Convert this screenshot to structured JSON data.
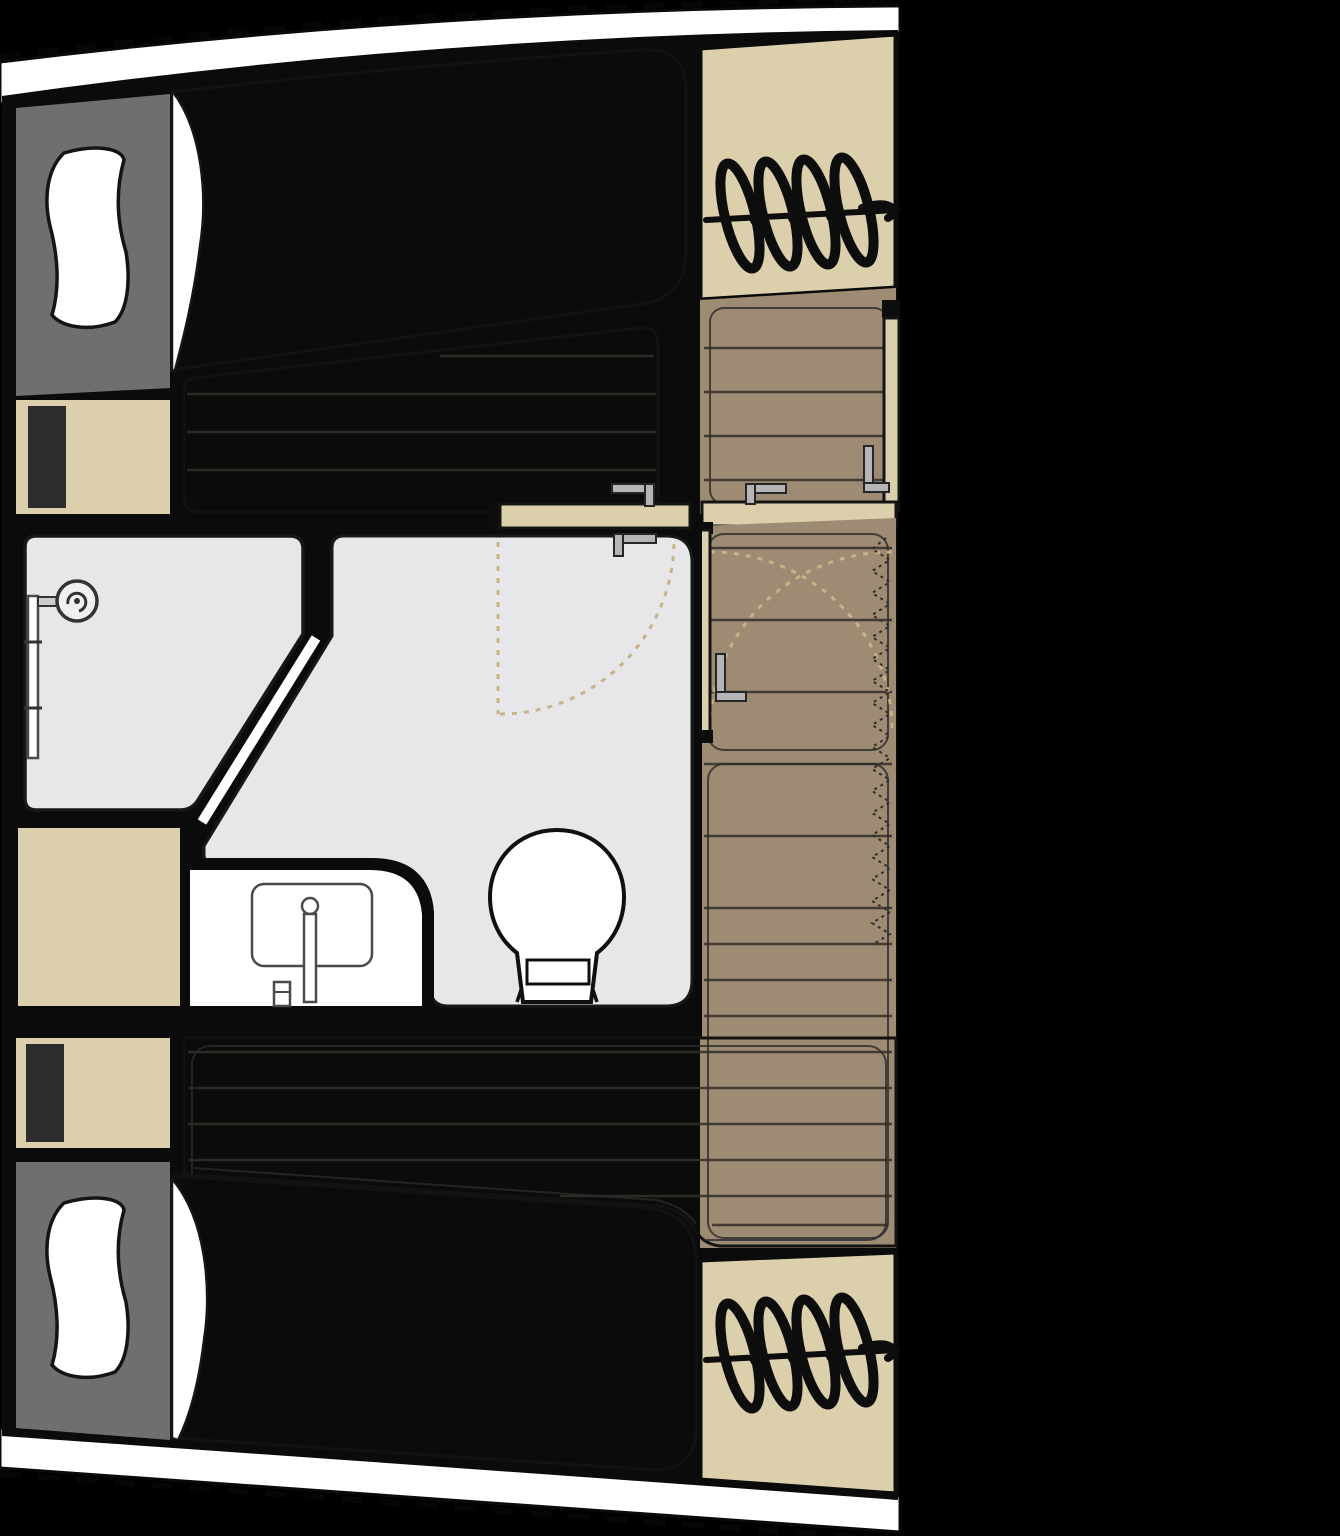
{
  "plan": {
    "type": "floor-plan",
    "subject": "yacht hull cabin deck plan",
    "areas": [
      {
        "id": "berth-forward",
        "label": "double berth forward"
      },
      {
        "id": "wardrobe-forward",
        "label": "wardrobe locker"
      },
      {
        "id": "steps-forward",
        "label": "companionway steps"
      },
      {
        "id": "steps-landing",
        "label": "steps landing"
      },
      {
        "id": "passageway",
        "label": "passageway"
      },
      {
        "id": "bathroom",
        "label": "shower room"
      },
      {
        "id": "shower-tray",
        "label": "shower tray"
      },
      {
        "id": "vanity-counter",
        "label": "washbasin counter"
      },
      {
        "id": "toilet",
        "label": "toilet"
      },
      {
        "id": "cabinet",
        "label": "cabinet"
      },
      {
        "id": "wardrobe-aft",
        "label": "wardrobe locker"
      },
      {
        "id": "berth-aft",
        "label": "double berth aft"
      },
      {
        "id": "steps-aft",
        "label": "companionway steps"
      }
    ],
    "fixtures": [
      "shower-head",
      "shower-rail",
      "sink-basin",
      "faucet",
      "toilet-bowl",
      "door-leaf",
      "door-handle",
      "door-swing-arc",
      "pillow",
      "mattress",
      "hull-outline",
      "folding-curtain"
    ]
  },
  "colors": {
    "canvas": "#000000",
    "hull": "#ffffff",
    "wall": "#0b0b0b",
    "wood": "#9d8b73",
    "beige": "#dccfab",
    "headboard": "#6f6f6f",
    "panel_dark": "#2d2d2d",
    "mattress": "#dadada",
    "bath": "#e7e7e9",
    "white": "#ffffff",
    "metal": "#b5b5b5",
    "swing": "#c9b287"
  }
}
